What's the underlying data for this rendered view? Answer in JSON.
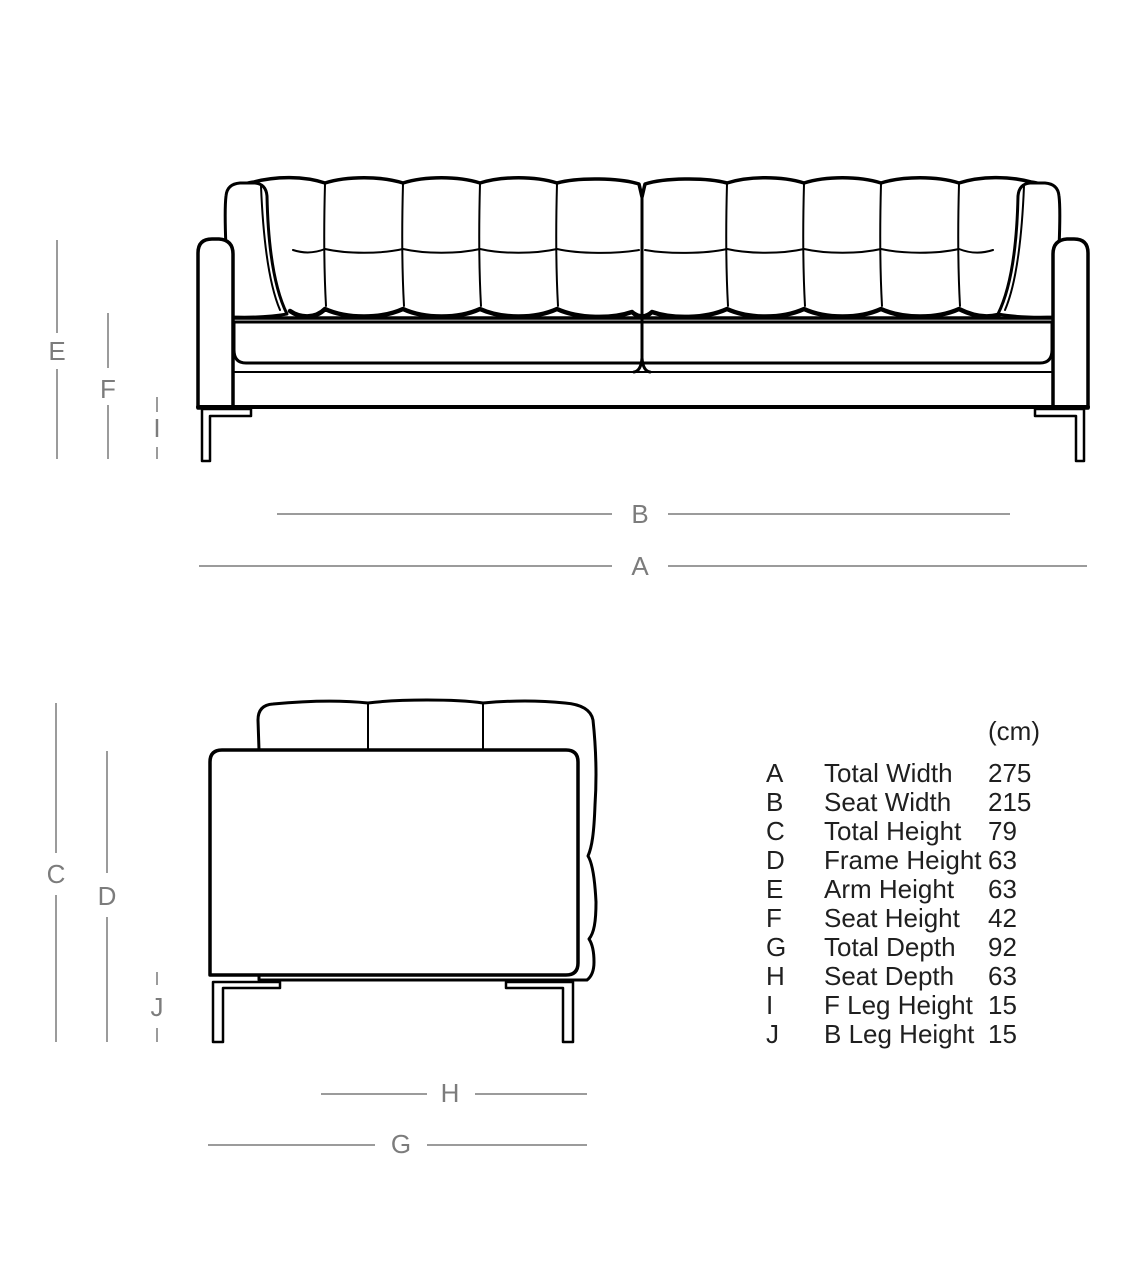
{
  "colors": {
    "background": "#ffffff",
    "drawing_line": "#000000",
    "dimension_line": "#9b9b9b",
    "dimension_label": "#7c7c7c",
    "table_text": "#1f1f1f"
  },
  "markers": {
    "A": "A",
    "B": "B",
    "C": "C",
    "D": "D",
    "E": "E",
    "F": "F",
    "G": "G",
    "H": "H",
    "I": "I",
    "J": "J"
  },
  "table": {
    "unit": "(cm)",
    "rows": [
      {
        "key": "A",
        "name": "Total Width",
        "value": "275"
      },
      {
        "key": "B",
        "name": "Seat Width",
        "value": "215"
      },
      {
        "key": "C",
        "name": "Total Height",
        "value": "79"
      },
      {
        "key": "D",
        "name": "Frame Height",
        "value": "63"
      },
      {
        "key": "E",
        "name": "Arm Height",
        "value": "63"
      },
      {
        "key": "F",
        "name": "Seat Height",
        "value": "42"
      },
      {
        "key": "G",
        "name": "Total Depth",
        "value": "92"
      },
      {
        "key": "H",
        "name": "Seat Depth",
        "value": "63"
      },
      {
        "key": "I",
        "name": "F Leg Height",
        "value": "15"
      },
      {
        "key": "J",
        "name": "B Leg Height",
        "value": "15"
      }
    ]
  }
}
